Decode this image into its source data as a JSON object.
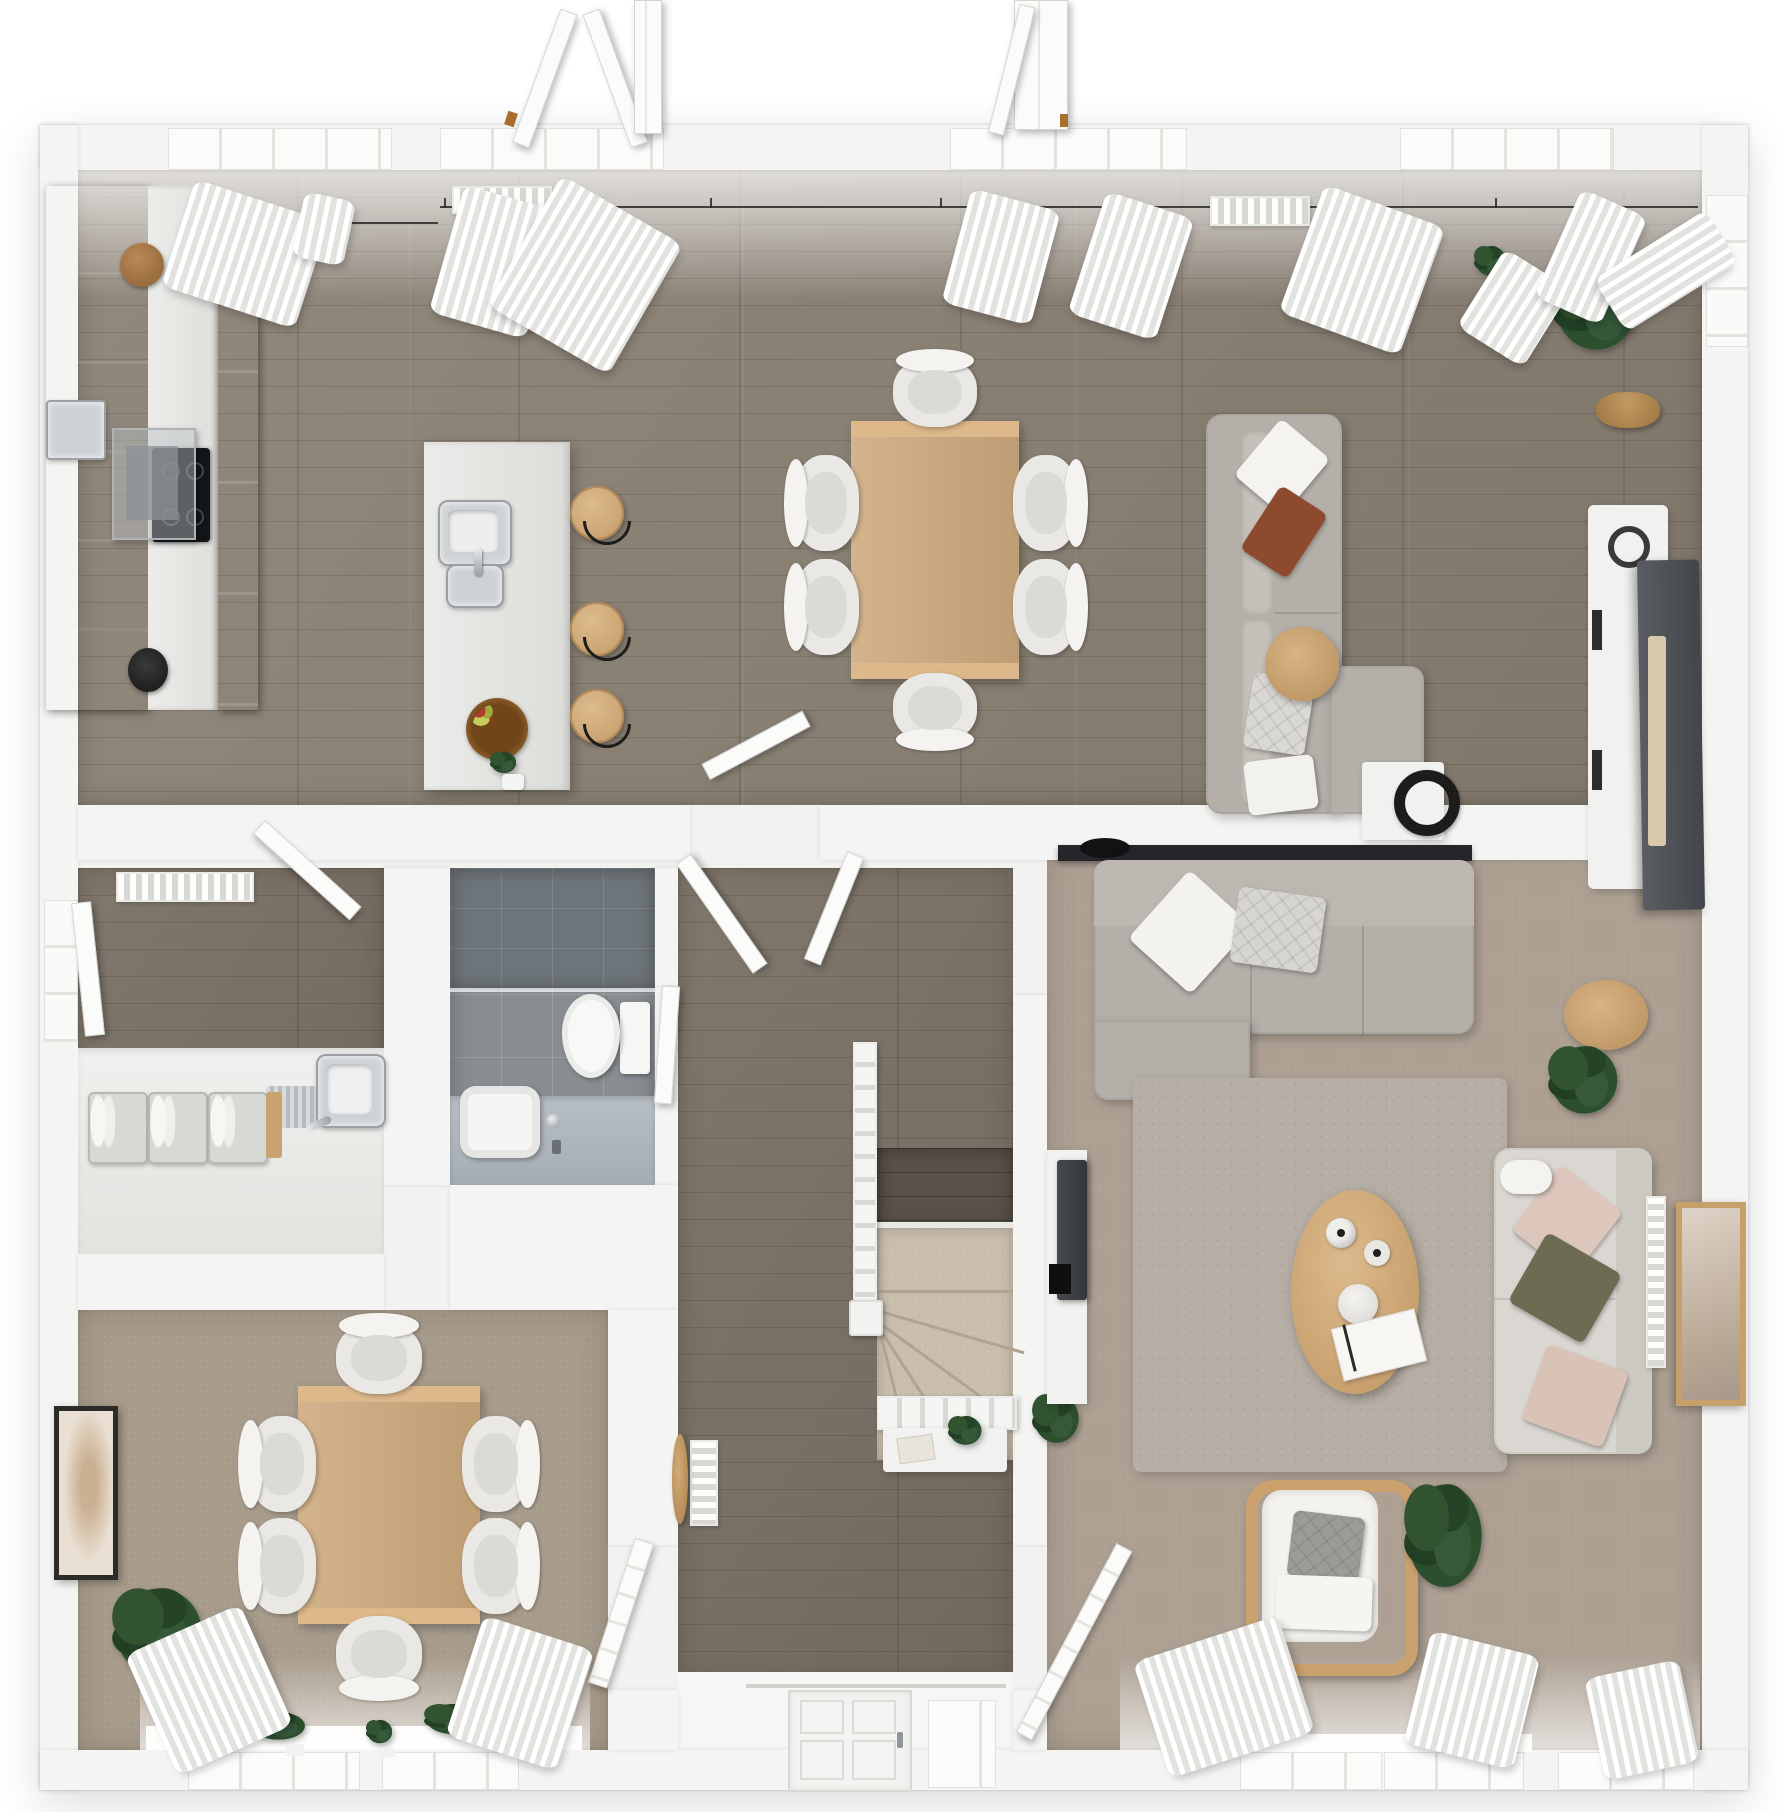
{
  "scene": {
    "description": "Top-down 3D dollhouse render of a ground-floor house plan",
    "view": "orthographic top-down",
    "background": "#ffffff"
  },
  "palette": {
    "wall": "#f4f4f2",
    "wood_floor": "#8b8174",
    "landing_wood": "#5a5249",
    "living_carpet": "#ada093",
    "dining_carpet": "#a79b8b",
    "stair_carpet": "#c9bdac",
    "bathroom_tile": "#878d91",
    "kitchen_black": "#17191b",
    "island_white": "#e8e8e6",
    "oak": "#cda97d",
    "sofa_grey": "#b4afa9",
    "sofa_light": "#d9d6d1",
    "rust_pillow": "#8e4a2f",
    "olive_pillow": "#6d6b52",
    "pink_pillow": "#dcc5ba",
    "plant_green": "#2c4f2e",
    "curtain_white": "#f0f0ee"
  },
  "rooms": {
    "open_plan": {
      "name": "open-plan kitchen / dining / family room",
      "floor": "grey-brown wood planks"
    },
    "kitchen": {
      "name": "kitchen",
      "cabinets": "black gloss",
      "island_stools": 3
    },
    "dining_area": {
      "name": "dining area",
      "chairs": 6
    },
    "tv_area": {
      "name": "tv lounge area",
      "sofa": "L-shaped grey sofa"
    },
    "utility": {
      "name": "utility room",
      "towel_baskets": 3
    },
    "bathroom": {
      "name": "bathroom",
      "floor": "grey tile"
    },
    "hallway": {
      "name": "hallway with staircase"
    },
    "entrance": {
      "name": "entrance with front door"
    },
    "living_room": {
      "name": "living room",
      "chairs_sofas": 3
    },
    "dining_room": {
      "name": "dining room",
      "chairs": 6
    }
  },
  "furniture": {
    "kitchen": [
      "black tall cabinet run",
      "built-in oven",
      "induction hob",
      "glass extractor hood",
      "white worktop",
      "island with twin steel sink",
      "3 oak bar stools",
      "fruit bowl",
      "herb pot"
    ],
    "dining_area": [
      "oak dining table",
      "6 white chairs"
    ],
    "tv_area": [
      "L-shaped grey sofa",
      "round oak side table",
      "white side table with black lamp",
      "white media console",
      "television",
      "fiddle-leaf plant in basket"
    ],
    "utility": [
      "radiator",
      "worktop with steel sink",
      "drainer grooves",
      "3 towel baskets"
    ],
    "bathroom": [
      "dark tiled shower zone",
      "toilet",
      "vanity with vessel basin and tap"
    ],
    "hallway": [
      "carpeted winder staircase",
      "white balustrade and newel",
      "console table with plant",
      "vertical radiator",
      "round wooden mirror"
    ],
    "entrance": [
      "white panelled front door",
      "glazed side panel"
    ],
    "living_room": [
      "grey corner sofa",
      "black wall shelf with bowl",
      "shaggy grey rug",
      "oval oak coffee table with vases and magazine",
      "light fabric sofa",
      "wooden armchair with cushions",
      "wall-mounted TV on panel",
      "monstera plants",
      "alocasia plant",
      "vertical radiator",
      "leaning framed artwork",
      "round oak side table"
    ],
    "dining_room": [
      "oak dining table",
      "6 white chairs",
      "monstera plant",
      "leaning framed artwork",
      "window-sill plants"
    ]
  },
  "openings": {
    "top_windows": 4,
    "open_casements_above_wall": 2,
    "curtain_bunches": 10,
    "interior_door_leaves": 6,
    "bottom_windows": 5
  }
}
